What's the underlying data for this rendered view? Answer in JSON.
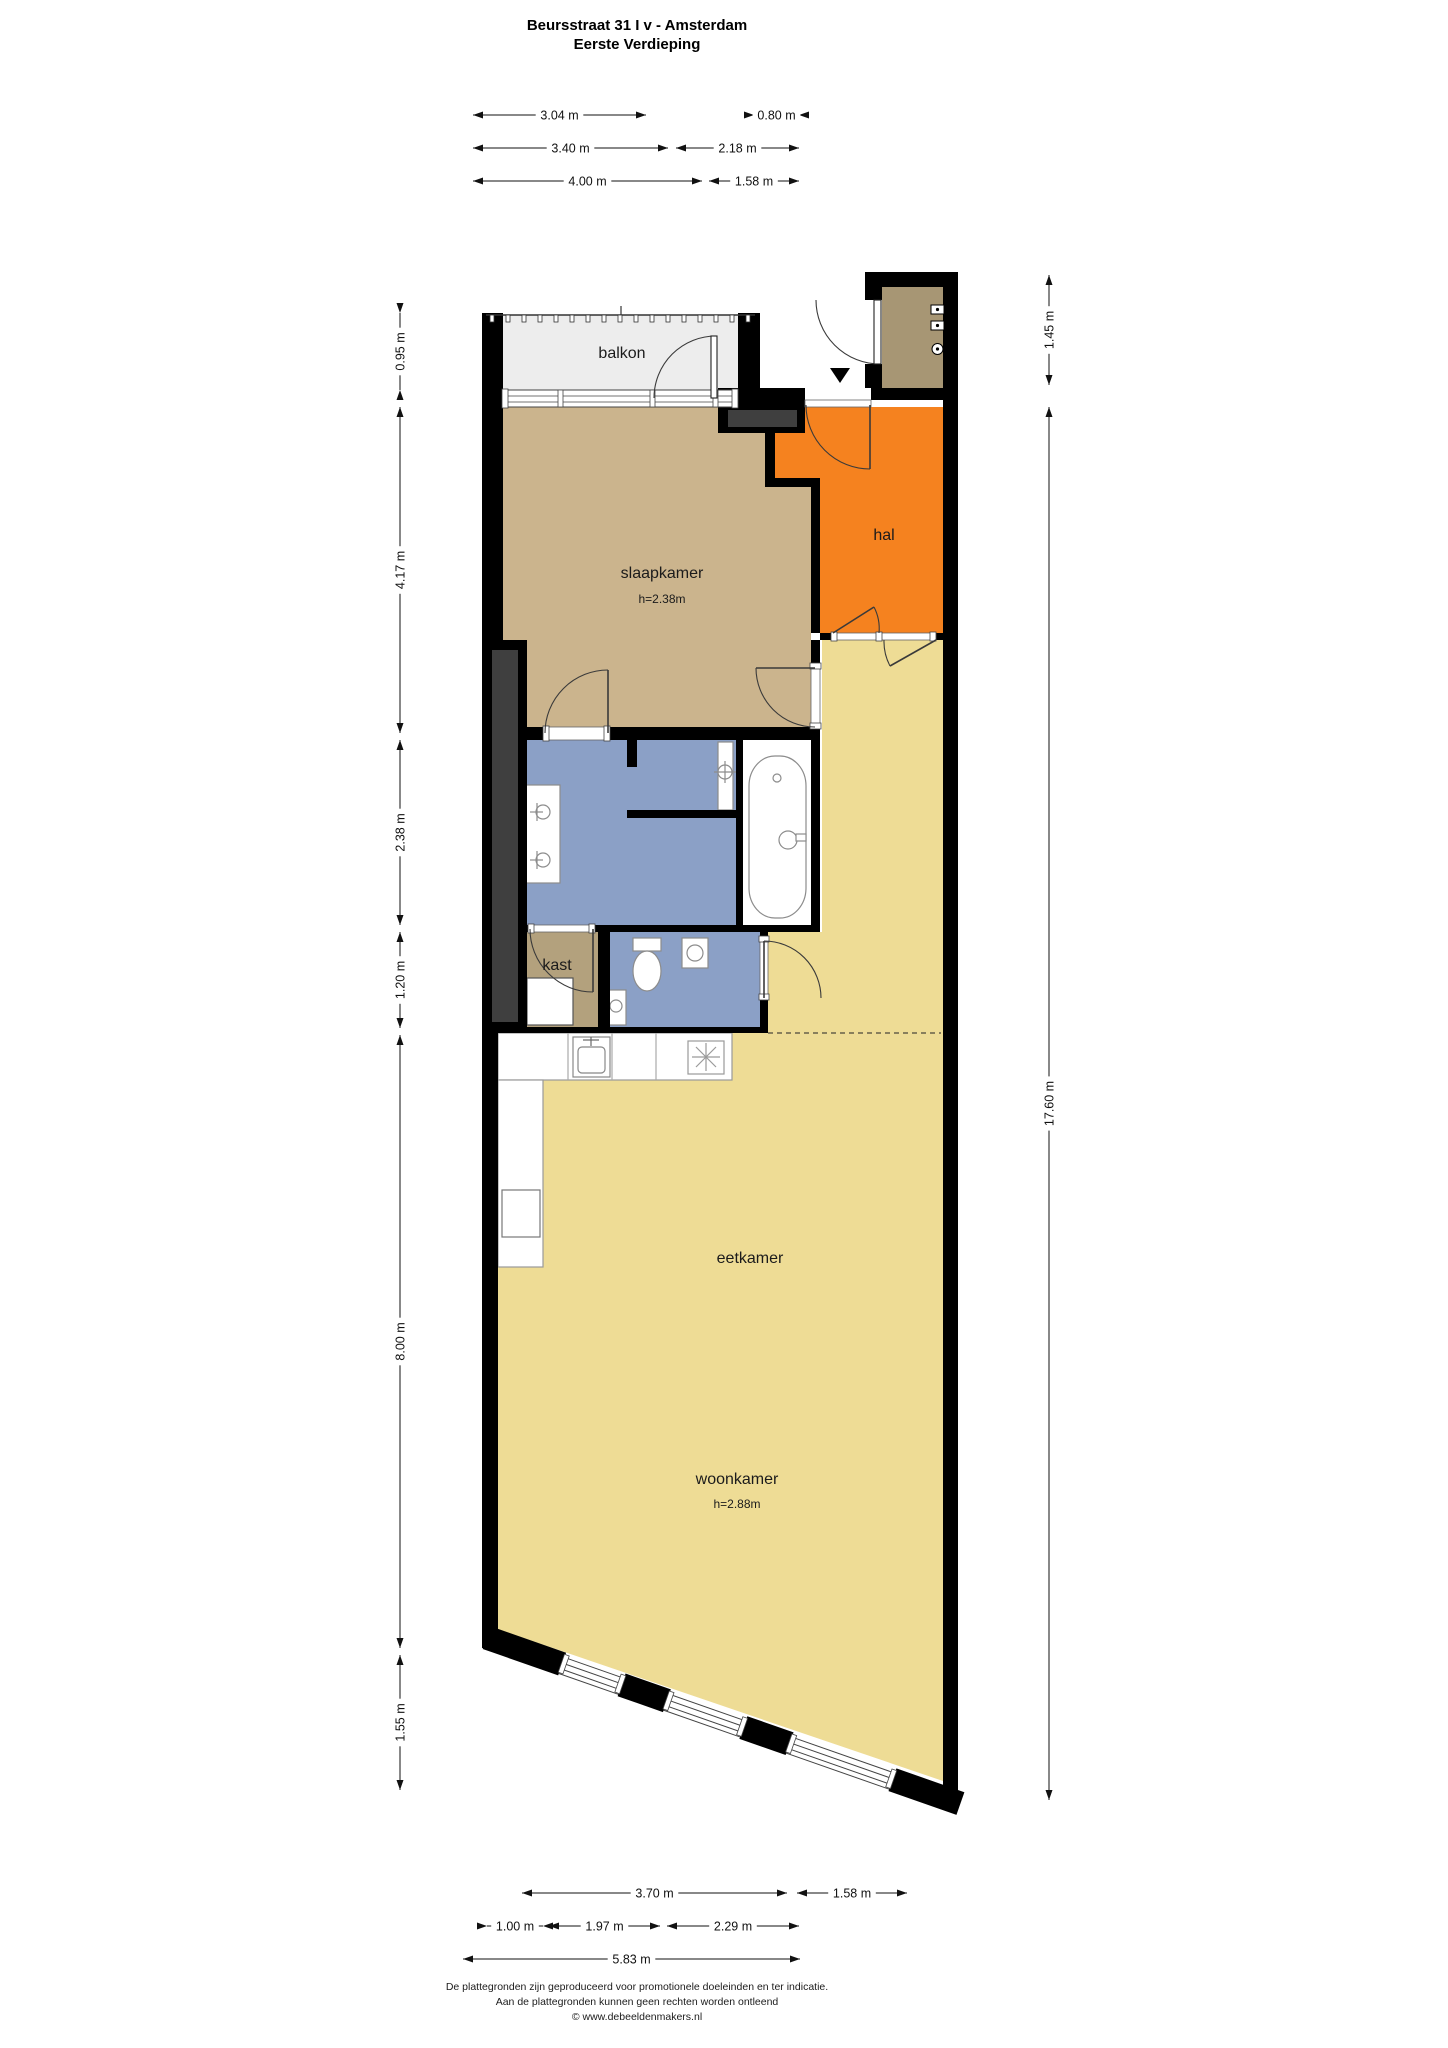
{
  "title": {
    "line1": "Beursstraat 31 I v - Amsterdam",
    "line2": "Eerste Verdieping"
  },
  "rooms": [
    {
      "key": "balkon",
      "label": "balkon",
      "cx": 622,
      "cy": 358
    },
    {
      "key": "slaapkamer",
      "label": "slaapkamer",
      "cx": 662,
      "cy": 578,
      "sublabel": "h=2.38m",
      "subcy": 603
    },
    {
      "key": "hal",
      "label": "hal",
      "cx": 884,
      "cy": 540
    },
    {
      "key": "kast",
      "label": "kast",
      "cx": 557,
      "cy": 970
    },
    {
      "key": "eetkamer",
      "label": "eetkamer",
      "cx": 750,
      "cy": 1263
    },
    {
      "key": "woonkamer",
      "label": "woonkamer",
      "cx": 737,
      "cy": 1484,
      "sublabel": "h=2.88m",
      "subcy": 1508
    }
  ],
  "dimensions": {
    "top": [
      {
        "label": "3.04 m",
        "x1": 473,
        "x2": 646,
        "y": 115
      },
      {
        "label": "0.80 m",
        "x1": 754,
        "x2": 799,
        "y": 115,
        "short": true
      },
      {
        "label": "3.40 m",
        "x1": 473,
        "x2": 668,
        "y": 148
      },
      {
        "label": "2.18 m",
        "x1": 676,
        "x2": 799,
        "y": 148
      },
      {
        "label": "4.00 m",
        "x1": 473,
        "x2": 702,
        "y": 181
      },
      {
        "label": "1.58 m",
        "x1": 709,
        "x2": 799,
        "y": 181
      }
    ],
    "bottom": [
      {
        "label": "3.70 m",
        "x1": 522,
        "x2": 787,
        "y": 1893
      },
      {
        "label": "1.58 m",
        "x1": 797,
        "x2": 907,
        "y": 1893
      },
      {
        "label": "1.00 m",
        "x1": 487,
        "x2": 543,
        "y": 1926,
        "short": true
      },
      {
        "label": "1.97 m",
        "x1": 549,
        "x2": 660,
        "y": 1926
      },
      {
        "label": "2.29 m",
        "x1": 667,
        "x2": 799,
        "y": 1926
      },
      {
        "label": "5.83 m",
        "x1": 463,
        "x2": 800,
        "y": 1959
      }
    ],
    "left": [
      {
        "label": "0.95 m",
        "y1": 313,
        "y2": 390,
        "x": 400,
        "short": true
      },
      {
        "label": "4.17 m",
        "y1": 407,
        "y2": 733,
        "x": 400
      },
      {
        "label": "2.38 m",
        "y1": 740,
        "y2": 925,
        "x": 400
      },
      {
        "label": "1.20 m",
        "y1": 932,
        "y2": 1028,
        "x": 400
      },
      {
        "label": "8.00 m",
        "y1": 1035,
        "y2": 1648,
        "x": 400
      },
      {
        "label": "1.55 m",
        "y1": 1655,
        "y2": 1790,
        "x": 400
      }
    ],
    "right": [
      {
        "label": "1.45 m",
        "y1": 275,
        "y2": 385,
        "x": 1049
      },
      {
        "label": "17.60 m",
        "y1": 407,
        "y2": 1800,
        "x": 1049
      }
    ]
  },
  "footer": {
    "line1": "De plattegronden zijn geproduceerd voor promotionele doeleinden en ter indicatie.",
    "line2": "Aan de plattegronden kunnen geen rechten worden ontleend",
    "line3": "© www.debeeldenmakers.nl"
  },
  "colors": {
    "wall": "#000000",
    "shaft": "#3f3f3f",
    "balkon": "#ededed",
    "slaapkamer": "#cbb48d",
    "hal": "#f5821f",
    "badkamer": "#8ba0c6",
    "toilet": "#8ba0c6",
    "kast": "#b3a17d",
    "berging": "#a79674",
    "eetkamer": "#eedc95",
    "woonkamer": "#eedc95",
    "dim_line": "#111111",
    "fixture_stroke": "#8c8c8c",
    "door_stroke": "#3a3a3a"
  }
}
